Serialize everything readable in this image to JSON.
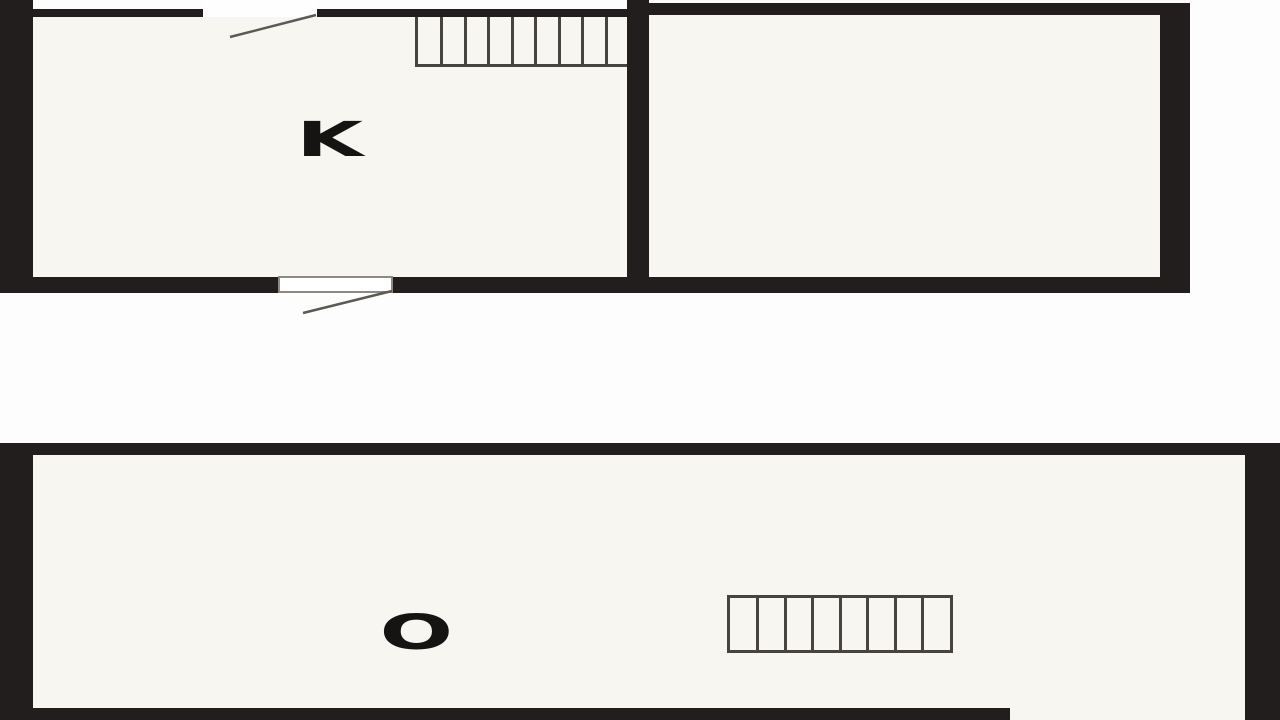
{
  "document": {
    "description": "Black-and-white architectural floor plan drawing of two storeys, cropped by the image frame",
    "background": "#fdfdfd"
  },
  "colors": {
    "wall": "#221e1d",
    "room_fill": "#f8f6f0",
    "outside": "#fdfdfd",
    "stair_line": "#47443f",
    "door_swing": "#5c5a55",
    "label": "#161412",
    "threshold_border": "#8d8a84"
  },
  "upper_floor": {
    "room_label": "K",
    "rooms": [
      "K",
      "unlabeled right room"
    ],
    "staircase_tread_lines": 8,
    "door_swings": 2
  },
  "lower_floor": {
    "room_label": "O",
    "rooms": [
      "O"
    ],
    "staircase_tread_lines": 7,
    "door_swings": 0
  }
}
